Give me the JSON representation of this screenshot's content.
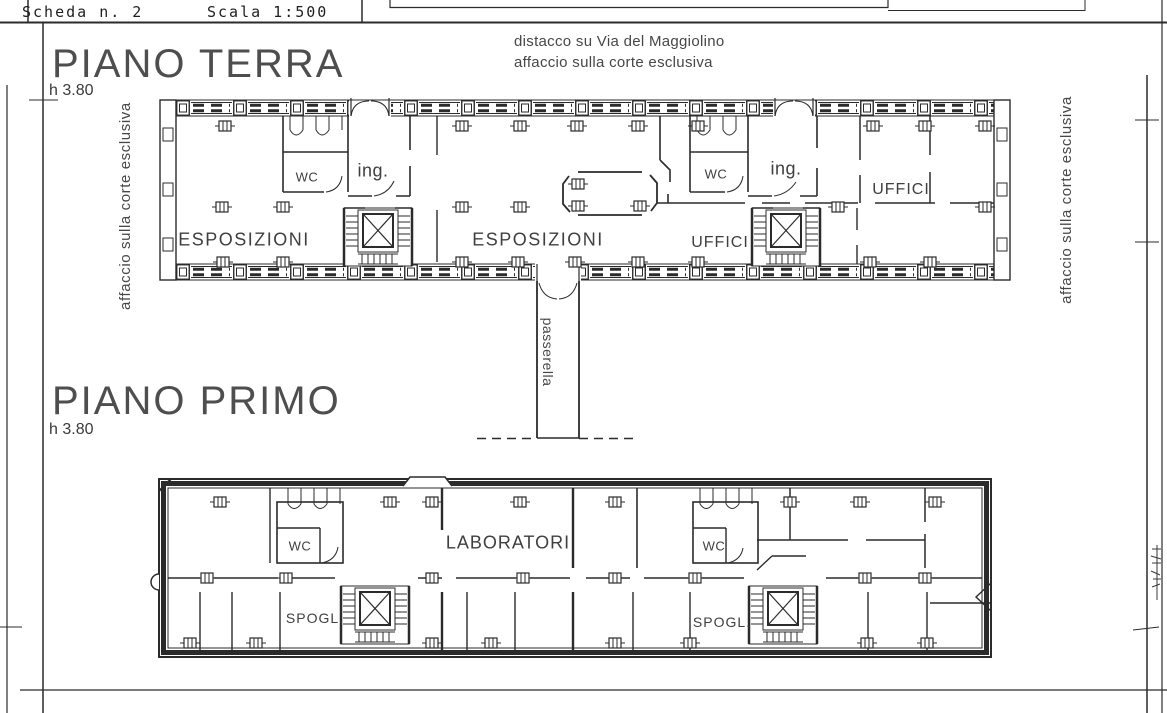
{
  "header": {
    "sheet_number_label": "Scheda n. 2",
    "scale_label": "Scala 1:500"
  },
  "annotations": {
    "street_distance_note": "distacco su Via del Maggiolino",
    "court_facing_note": "affaccio sulla corte esclusiva",
    "left_margin_vertical": "affaccio sulla corte esclusiva",
    "right_margin_vertical": "affaccio sulla corte esclusiva",
    "walkway_label": "passerella"
  },
  "ground_floor": {
    "title": "PIANO TERRA",
    "height_label": "h 3.80",
    "rooms": {
      "esposizioni_left": "ESPOSIZIONI",
      "wc_left": "WC",
      "ing_left": "ing.",
      "esposizioni_center": "ESPOSIZIONI",
      "uffici_center": "UFFICI",
      "wc_right": "WC",
      "ing_right": "ing.",
      "uffici_right": "UFFICI"
    }
  },
  "first_floor": {
    "title": "PIANO PRIMO",
    "height_label": "h 3.80",
    "rooms": {
      "wc_left": "WC",
      "spogl_left": "SPOGL.",
      "laboratori": "LABORATORI",
      "wc_right": "WC",
      "spogl_right": "SPOGL."
    }
  },
  "colors": {
    "ink": "#2b2b2b",
    "label_gray": "#3f3f3f",
    "title_gray": "#4e4e4e",
    "paper": "#ffffff"
  }
}
